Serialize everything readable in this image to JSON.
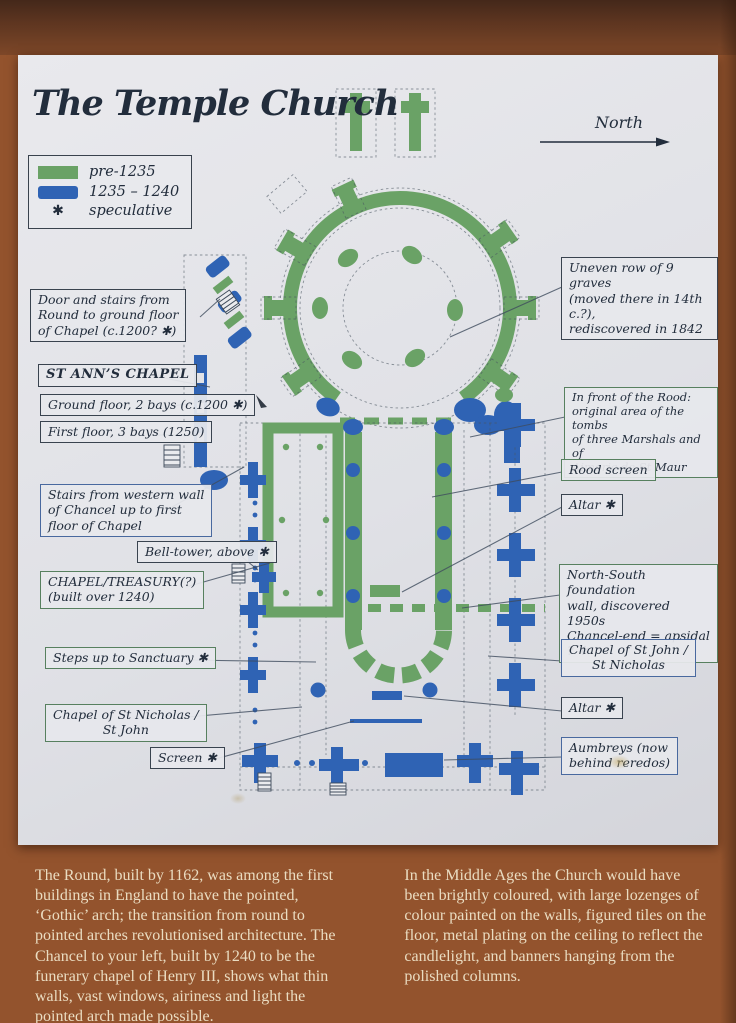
{
  "title": "The Temple Church",
  "compass": {
    "label": "North"
  },
  "legend": {
    "pre_label": "pre-1235",
    "mid_label": "1235 – 1240",
    "spec_symbol": "✱",
    "spec_label": "speculative"
  },
  "annotations": {
    "door_stairs": {
      "text": "Door and stairs from\nRound to ground floor\nof Chapel (c.1200? ✱)"
    },
    "st_anns": {
      "text": "ST ANN’S CHAPEL"
    },
    "ground_floor": {
      "text": "Ground floor, 2 bays (c.1200 ✱)"
    },
    "first_floor": {
      "text": "First floor, 3 bays (1250)"
    },
    "stairs_west": {
      "text": "Stairs from western wall\nof Chancel up to first\nfloor of Chapel"
    },
    "bell_tower": {
      "text": "Bell-tower, above ✱"
    },
    "chapel_treasury": {
      "text": "CHAPEL/TREASURY(?)\n(built over 1240)"
    },
    "steps_sanctuary": {
      "text": "Steps up to Sanctuary ✱"
    },
    "chapel_st_nicholas": {
      "text": "Chapel of St Nicholas /\nSt John"
    },
    "screen": {
      "text": "Screen ✱"
    },
    "graves": {
      "text": "Uneven row of 9 graves\n(moved there in 14th c.?),\nrediscovered in 1842"
    },
    "rood_front": {
      "text": "In front of the Rood:\noriginal area of the tombs\nof three Marshals and of\nAimeric de St Maur"
    },
    "rood_screen": {
      "text": "Rood screen"
    },
    "altar_north": {
      "text": "Altar ✱"
    },
    "ns_wall": {
      "text": "North-South foundation\nwall, discovered 1950s\nChancel-end = apsidal ? ✱"
    },
    "chapel_st_john": {
      "text": "Chapel of St John /\nSt Nicholas"
    },
    "altar_south": {
      "text": "Altar ✱"
    },
    "aumbreys": {
      "text": "Aumbreys (now\nbehind reredos)"
    }
  },
  "footer": {
    "left": "The Round, built by 1162, was among the first buildings in England to have the pointed, ‘Gothic’ arch; the transition from round to pointed arches revolutionised architecture. The Chancel to your left, built by 1240 to be the funerary chapel of Henry III, shows what thin walls, vast windows, airiness and light the pointed arch made possible.",
    "right": "In the Middle Ages the Church would have been brightly coloured, with large lozenges of colour painted on the walls, figured tiles on the floor, metal plating on the ceiling to reflect the candlelight, and banners hanging from the polished columns."
  },
  "colors": {
    "frame": "#93532d",
    "panel": "#e0e1e6",
    "green": "#6aa266",
    "blue": "#2f63b4",
    "ink": "#222d3c",
    "footer_text": "#eadcc1"
  }
}
